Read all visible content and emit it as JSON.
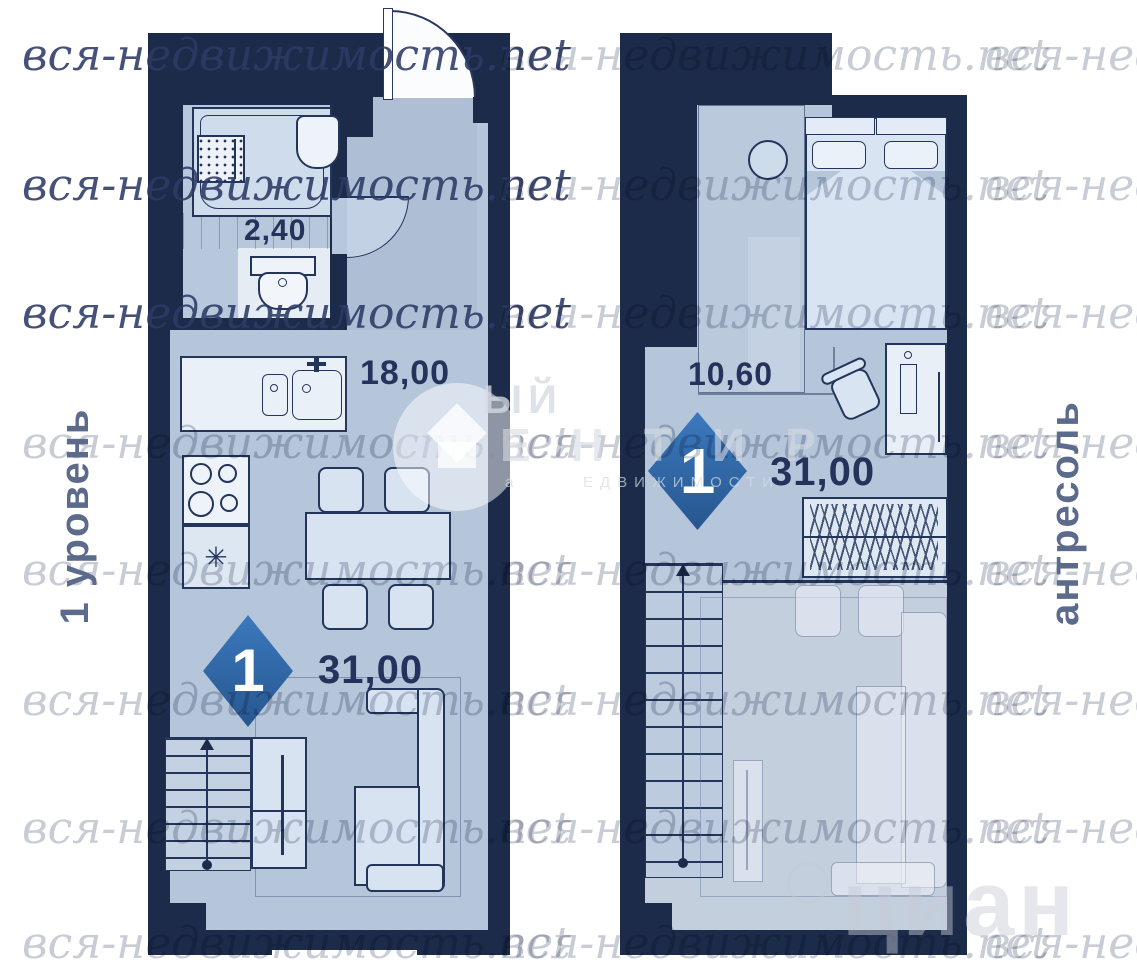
{
  "watermarks": {
    "pattern": "вся-недвижимость.net",
    "agency": {
      "big_top": "ЫЙ",
      "big_bottom": "ЕНТИР",
      "small": "ЕДВИЖИМОСТИ",
      "fragment": "а"
    },
    "portal": "циан"
  },
  "side_labels": {
    "left": "1 уровень",
    "right": "антресоль"
  },
  "level1": {
    "badge": "1",
    "area_bathroom": "2,40",
    "area_room": "18,00",
    "area_total": "31,00"
  },
  "mezzanine": {
    "badge": "1",
    "area_room": "10,60",
    "area_total": "31,00"
  },
  "symbols": {
    "fridge": "✳"
  }
}
